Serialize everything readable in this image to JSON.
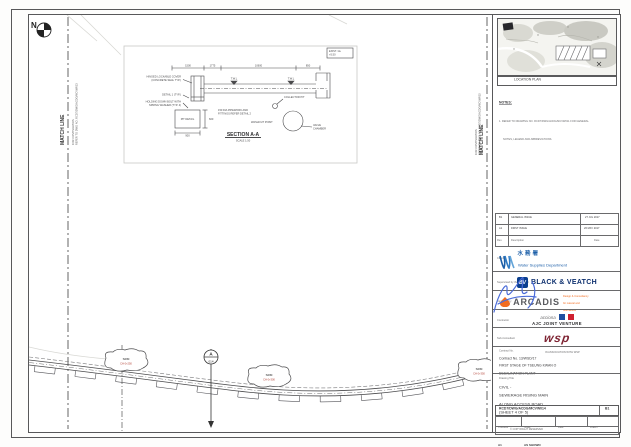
{
  "colors": {
    "line": "#4a4a4a",
    "wsd_blue": "#1c5fa8",
    "bv_blue": "#0a3f8f",
    "arcadis_orange": "#f26c1f",
    "arcadis_gray": "#595a5e",
    "wsp_maroon": "#7e2433",
    "jv_blue": "#1f4fa0",
    "jv_red": "#cf2030",
    "signature_blue": "#4a6bd8",
    "callout_red": "#b03a2e"
  },
  "drawing": {
    "north_label": "N",
    "match_line_left": {
      "title": "MATCH LINE",
      "note1": "FOR CONTINUATION",
      "note2": "REFER TO DWG NO. RCD7/DWG/ACDG/MCVW013"
    },
    "match_line_right": {
      "title": "MATCH LINE",
      "note1": "FOR CONTINUATION",
      "note2": "REFER TO DWG NO. RCD7/DWG/ACDG/MCVW015"
    },
    "section_detail": {
      "title": "SECTION A-A",
      "scale": "SCALE 1:50",
      "level_box_1": "EXIST. GL",
      "level_box_2": "+5.50",
      "dim_1": "1500",
      "dim_2": "1775",
      "dim_3": "10600",
      "dim_4": "850",
      "label_cover_1": "HINGED LOCKABLE COVER",
      "label_cover_2": "(CONCRETE SEAL TYP.)",
      "label_detail": "DETAIL 1 (TYP.)",
      "label_bolt_1": "HOLDING DOWN BOLT WITH",
      "label_bolt_2": "SPRING WASHER (TYP. 4)",
      "label_pit": "PIT DETAIL",
      "label_collector": "COLLECTOR PIT",
      "label_washout": "WASHOUT POINT",
      "label_valve_1": "VALVE",
      "label_valve_2": "CHAMBER",
      "level_1": "T.W.L",
      "level_2": "T.W.L",
      "note_1": "150 DIA PIPEWORK AND",
      "note_2": "FITTINGS REFER DETAIL 2",
      "pit_dim_w": "900",
      "pit_dim_h": "600"
    },
    "plan": {
      "callout_1": {
        "line1": "SRM",
        "line2": "CH 0+250"
      },
      "callout_2": {
        "line1": "SRM",
        "line2": "CH 0+300"
      },
      "callout_3": {
        "line1": "SRM",
        "line2": "CH 0+350"
      },
      "section_marker": {
        "letter": "A",
        "ref": "014"
      }
    }
  },
  "titleblock": {
    "location_plan_caption": "LOCATION PLAN",
    "notes_heading": "NOTES:",
    "note_1a": "1.  REFER TO DRAWING NO. RCD7/DWG/ACDG/MCVW011 FOR GENERAL",
    "note_1b": "NOTES, LEGEND AND ABBREVIATIONS.",
    "rev_rows": [
      [
        "B1",
        "GENERAL ISSUE",
        "27 JUL 2017"
      ],
      [
        "A1",
        "FIRST ISSUE",
        "26 MAY 2017"
      ],
      [
        "Rev.",
        "Description",
        "Date"
      ]
    ],
    "captions": {
      "client": "Client",
      "engineer": "Supervised by the Engineer",
      "designer": "Designed by",
      "contractor": "Contractor",
      "subconsultant": "Sub-Consultant",
      "contract": "Contract No.",
      "title": "Drawing Title",
      "dwg": "Drawing No.",
      "scale": "Scale",
      "date": "Date",
      "drawn": "Drawn",
      "checked": "Checked",
      "rev": "Rev."
    },
    "wsd": {
      "cjk": "水務署",
      "en": "Water Supplies Department"
    },
    "bv": {
      "mono": "BV",
      "name": "BLACK & VEATCH"
    },
    "arcadis": {
      "name": "ARCADIS",
      "tag1": "Design & Consultancy",
      "tag2": "for natural and",
      "tag3": "built assets"
    },
    "ajc": {
      "pre": "acciona",
      "name": "AJC JOINT VENTURE"
    },
    "wsp": {
      "name": "wsp",
      "assoc": "IN ASSOCIATION WITH WSP"
    },
    "contract_no": "Contract No. 13/WSD/17",
    "contract_line1": "FIRST STAGE OF TSEUNG KWAN O",
    "contract_line2": "DESALINATION PLANT",
    "title_line1": "CIVIL -",
    "title_line2": "SEWERAGE RISING MAIN",
    "title_line3": "ALONG ACCESS ROAD",
    "title_line4": "(SHEET 4 OF 5)",
    "dwg_no": "RCD7/DWG/ACDG/MCVW014",
    "rev": "B1",
    "scale_value": "AS SHOWN",
    "size_value": "A1",
    "copyright": "© COPYRIGHT RESERVED"
  }
}
